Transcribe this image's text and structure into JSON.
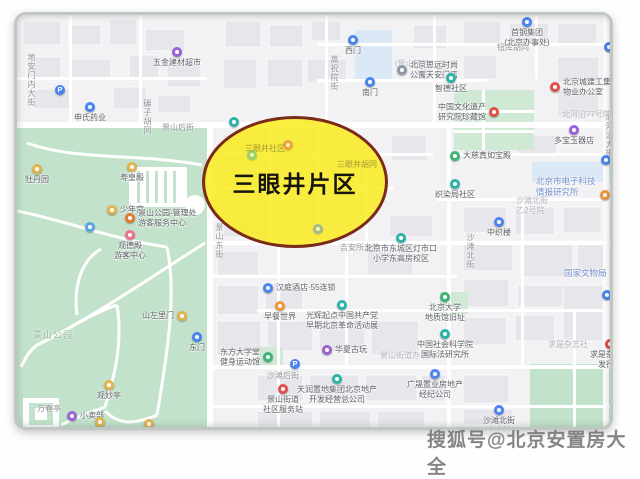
{
  "highlight": {
    "label": "三眼井片区",
    "fill": "#f9eb1f",
    "border": "#7b2a18"
  },
  "watermark": {
    "text": "搜狐号@北京安置房大全",
    "color": "#8b8b8b"
  },
  "map": {
    "pin_colors": {
      "blue": "#4a85f0",
      "teal": "#2fb3a9",
      "purple": "#9a63d6",
      "red": "#e0504b",
      "orange": "#f0973b",
      "yellow": "#e4b44c",
      "gray": "#8d98a8",
      "green": "#41b377",
      "darkorange": "#e07b36",
      "pink": "#ee6f8e",
      "parkblue": "#57a5e8"
    },
    "pins": [
      {
        "x": 160,
        "y": 37,
        "color": "purple",
        "lines": [
          "五金建材超市"
        ],
        "labelPos": "below"
      },
      {
        "x": 43,
        "y": 75,
        "color": "blue",
        "glyph": "P"
      },
      {
        "x": 73,
        "y": 92,
        "color": "blue",
        "lines": [
          "申氏药业"
        ],
        "labelPos": "below"
      },
      {
        "x": 336,
        "y": 25,
        "color": "blue",
        "lines": [
          "西门"
        ],
        "labelPos": "below"
      },
      {
        "x": 353,
        "y": 67,
        "color": "blue",
        "lines": [
          "南门"
        ],
        "labelPos": "below"
      },
      {
        "x": 385,
        "y": 55,
        "color": "gray",
        "lines": [
          "北京思远时尚",
          "公寓天安门店"
        ],
        "labelPos": "right"
      },
      {
        "x": 510,
        "y": 7,
        "color": "blue",
        "lines": [
          "首钢集团",
          "(北京办事处)"
        ],
        "labelPos": "below"
      },
      {
        "x": 434,
        "y": 63,
        "color": "teal",
        "lines": [
          "智德社区"
        ],
        "labelPos": "below"
      },
      {
        "x": 538,
        "y": 72,
        "color": "red",
        "lines": [
          "北京城建工集团",
          "物业办公室"
        ],
        "labelPos": "right"
      },
      {
        "x": 477,
        "y": 97,
        "color": "red",
        "lines": [
          "中国文化遗产",
          "研究院珍藏馆"
        ],
        "labelPos": "left"
      },
      {
        "x": 438,
        "y": 141,
        "color": "green",
        "lines": [
          "大慈真如宝殿"
        ],
        "labelPos": "right"
      },
      {
        "x": 438,
        "y": 169,
        "color": "teal",
        "lines": [
          "织染局社区"
        ],
        "labelPos": "below"
      },
      {
        "x": 482,
        "y": 207,
        "color": "blue",
        "lines": [
          "中织楼"
        ],
        "labelPos": "below"
      },
      {
        "x": 557,
        "y": 115,
        "color": "purple",
        "lines": [
          "多宝玉器店"
        ],
        "labelPos": "below"
      },
      {
        "x": 589,
        "y": 145,
        "color": "blue"
      },
      {
        "x": 588,
        "y": 180,
        "color": "orange"
      },
      {
        "x": 592,
        "y": 32,
        "color": "blue"
      },
      {
        "x": 217,
        "y": 107,
        "color": "teal"
      },
      {
        "x": 384,
        "y": 223,
        "color": "teal",
        "lines": [
          "北京市东城区灯市口",
          "小学东高房校区"
        ],
        "labelPos": "below"
      },
      {
        "x": 251,
        "y": 273,
        "color": "blue",
        "lines": [
          "汉庭酒店·55连锁"
        ],
        "labelPos": "right"
      },
      {
        "x": 263,
        "y": 291,
        "color": "orange",
        "lines": [
          "早餐世界"
        ],
        "labelPos": "below"
      },
      {
        "x": 325,
        "y": 290,
        "color": "teal",
        "lines": [
          "光辉起点中国共产党",
          "早期北京革命活动展"
        ],
        "labelPos": "below"
      },
      {
        "x": 180,
        "y": 322,
        "color": "blue",
        "lines": [
          "东门"
        ],
        "labelPos": "below"
      },
      {
        "x": 251,
        "y": 342,
        "color": "green",
        "lines": [
          "东方大学堂",
          "健身运动馆"
        ],
        "labelPos": "left"
      },
      {
        "x": 278,
        "y": 349,
        "color": "blue",
        "glyph": "P"
      },
      {
        "x": 310,
        "y": 335,
        "color": "purple",
        "lines": [
          "华夏古玩"
        ],
        "labelPos": "right"
      },
      {
        "x": 320,
        "y": 364,
        "color": "teal",
        "lines": [
          "天润置地集团北京地产",
          "开发经营总公司"
        ],
        "labelPos": "below"
      },
      {
        "x": 266,
        "y": 374,
        "color": "red",
        "lines": [
          "景山街道",
          "社区服务站"
        ],
        "labelPos": "below"
      },
      {
        "x": 428,
        "y": 282,
        "color": "green",
        "lines": [
          "北京大学",
          "地质馆旧址"
        ],
        "labelPos": "below"
      },
      {
        "x": 428,
        "y": 319,
        "color": "teal",
        "lines": [
          "中国社会科学院",
          "国际法研究所"
        ],
        "labelPos": "below"
      },
      {
        "x": 418,
        "y": 359,
        "color": "blue",
        "lines": [
          "广晟置业房地产",
          "经纪公司"
        ],
        "labelPos": "below"
      },
      {
        "x": 593,
        "y": 329,
        "color": "red",
        "lines": [
          "求是杂志社",
          "发行部"
        ],
        "labelPos": "below"
      },
      {
        "x": 482,
        "y": 395,
        "color": "blue",
        "lines": [
          "沙滩北街",
          "充电站"
        ],
        "labelPos": "below"
      },
      {
        "x": 590,
        "y": 280,
        "color": "blue"
      },
      {
        "x": 20,
        "y": 154,
        "color": "yellow",
        "lines": [
          "牡丹园"
        ],
        "labelPos": "below"
      },
      {
        "x": 115,
        "y": 152,
        "color": "yellow",
        "lines": [
          "寿皇殿"
        ],
        "labelPos": "below"
      },
      {
        "x": 95,
        "y": 195,
        "color": "yellow",
        "lines": [
          "少年宫"
        ],
        "labelPos": "right"
      },
      {
        "x": 113,
        "y": 203,
        "color": "darkorange",
        "lines": [
          "景山公园-管理处",
          "游客服务中心"
        ],
        "labelPos": "right"
      },
      {
        "x": 113,
        "y": 220,
        "color": "pink",
        "lines": [
          "观德殿",
          "游客中心"
        ],
        "labelPos": "below"
      },
      {
        "x": 73,
        "y": 212,
        "color": "parkblue"
      },
      {
        "x": 92,
        "y": 370,
        "color": "yellow",
        "lines": [
          "观妙亭"
        ],
        "labelPos": "below"
      },
      {
        "x": 165,
        "y": 301,
        "color": "yellow",
        "lines": [
          "山左里门"
        ],
        "labelPos": "left"
      },
      {
        "x": 55,
        "y": 401,
        "color": "purple",
        "lines": [
          "小卖部"
        ],
        "labelPos": "right"
      },
      {
        "x": 83,
        "y": 407,
        "color": "yellow"
      },
      {
        "x": 132,
        "y": 409,
        "color": "yellow"
      },
      {
        "x": 235,
        "y": 140,
        "color": "teal",
        "dim": true
      },
      {
        "x": 301,
        "y": 214,
        "color": "blue",
        "dim": true
      },
      {
        "x": 271,
        "y": 130,
        "color": "red",
        "dim": true
      }
    ],
    "labels": [
      {
        "x": 145,
        "y": 108,
        "lines": [
          "景山后街"
        ],
        "style": "street"
      },
      {
        "x": 125,
        "y": 84,
        "lines": [
          "碾子胡同"
        ],
        "style": "street",
        "orient": "v"
      },
      {
        "x": 197,
        "y": 208,
        "lines": [
          "景山东街"
        ],
        "style": "street",
        "orient": "v"
      },
      {
        "x": 312,
        "y": 40,
        "lines": [
          "嵩祝院街"
        ],
        "style": "street",
        "orient": "v"
      },
      {
        "x": 480,
        "y": 28,
        "lines": [
          "钮库胡同"
        ],
        "style": "street"
      },
      {
        "x": 378,
        "y": 44,
        "lines": [
          "(景山学校)"
        ],
        "style": "faint"
      },
      {
        "x": 448,
        "y": 218,
        "lines": [
          "沙滩北街"
        ],
        "style": "street",
        "orient": "v"
      },
      {
        "x": 587,
        "y": 98,
        "lines": [
          "北河沿大街"
        ],
        "style": "street",
        "orient": "v"
      },
      {
        "x": 250,
        "y": 356,
        "lines": [
          "沙滩后街"
        ],
        "style": "street"
      },
      {
        "x": 323,
        "y": 228,
        "lines": [
          "吉安所左巷"
        ],
        "style": "street"
      },
      {
        "x": 320,
        "y": 145,
        "lines": [
          "三眼井胡同"
        ],
        "style": "innerfaint"
      },
      {
        "x": 228,
        "y": 129,
        "lines": [
          "三眼井社区"
        ],
        "style": "innerfaint"
      },
      {
        "x": 16,
        "y": 315,
        "lines": [
          "景山公园"
        ],
        "style": "park"
      },
      {
        "x": 20,
        "y": 389,
        "lines": [
          "万春亭"
        ],
        "style": "street"
      },
      {
        "x": 545,
        "y": 95,
        "lines": [
          "北河沿77号院"
        ],
        "style": "faint"
      },
      {
        "x": 519,
        "y": 161,
        "lines": [
          "北京市电子科技",
          "情报研究所"
        ],
        "style": "blue"
      },
      {
        "x": 547,
        "y": 253,
        "lines": [
          "国家文物局"
        ],
        "style": "blue"
      },
      {
        "x": 531,
        "y": 325,
        "lines": [
          "求是杂志社"
        ],
        "style": "faint"
      },
      {
        "x": 363,
        "y": 336,
        "lines": [
          "景山街道办事处"
        ],
        "style": "faint"
      },
      {
        "x": 9,
        "y": 38,
        "lines": [
          "地安门内大街"
        ],
        "style": "street",
        "orient": "v"
      },
      {
        "x": 499,
        "y": 181,
        "lines": [
          "沙滩北街",
          "乙2号院"
        ],
        "style": "faint"
      }
    ]
  }
}
